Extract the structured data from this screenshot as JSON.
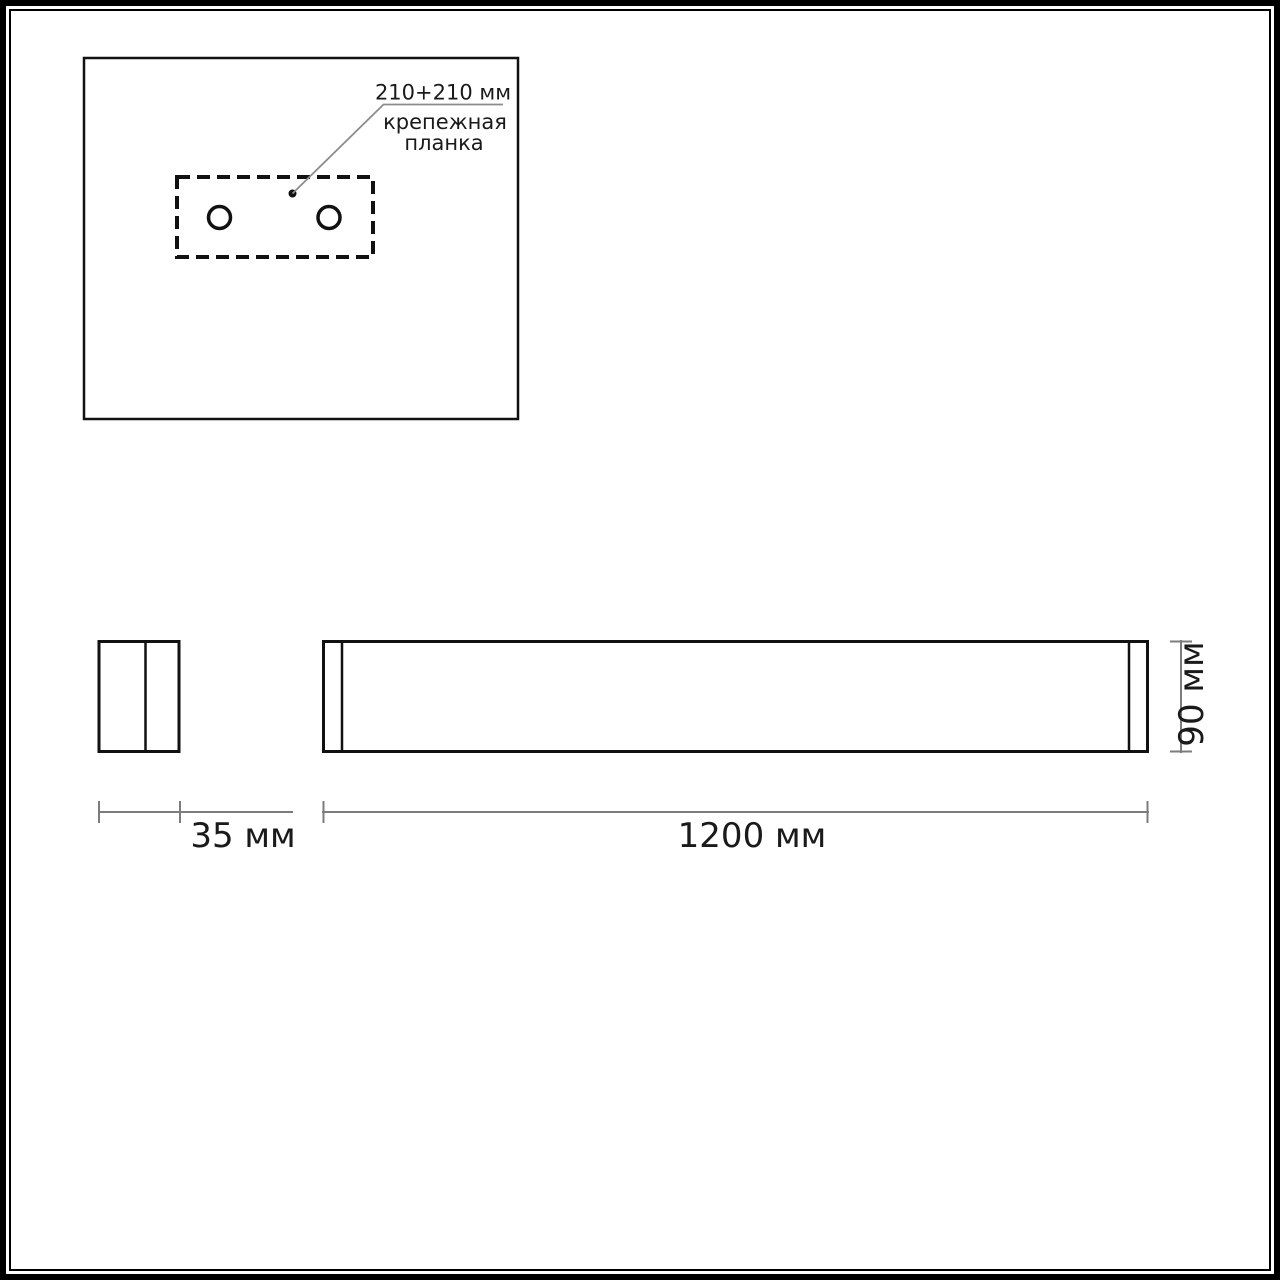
{
  "colors": {
    "drawing_line": "#111111",
    "dimension_line": "#7c7c7c",
    "leader_line": "#8c8c8c",
    "text": "#1a1a1a",
    "background": "#ffffff"
  },
  "mounting_detail": {
    "spacing_label": "210+210 мм",
    "caption_line1": "крепежная",
    "caption_line2": "планка"
  },
  "dimensions": {
    "depth_label": "35 мм",
    "length_label": "1200 мм",
    "height_label": "90 мм"
  }
}
